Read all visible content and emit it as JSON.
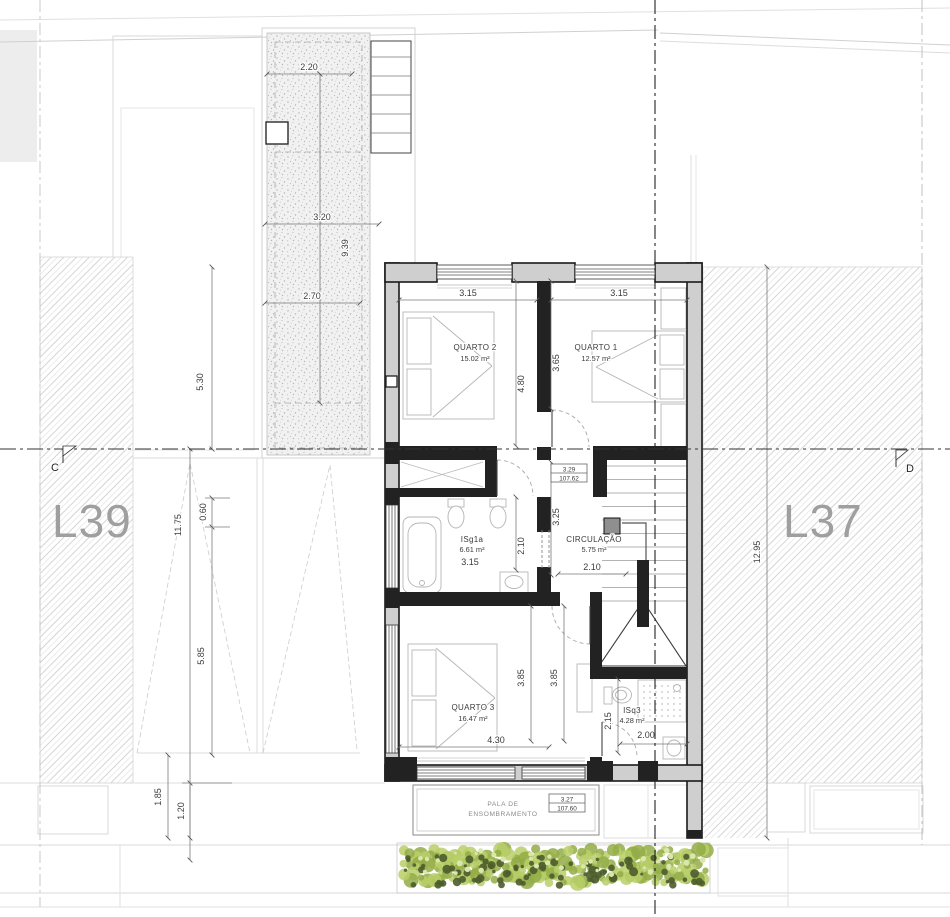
{
  "drawing": {
    "lots": {
      "left_label": "L39",
      "right_label": "L37"
    },
    "section_markers": {
      "left": "C",
      "right": "D"
    },
    "rooms": {
      "quarto2": {
        "name": "QUARTO 2",
        "area": "15.02 m²"
      },
      "quarto1": {
        "name": "QUARTO 1",
        "area": "12.57 m²"
      },
      "isg1a": {
        "name": "ISg1a",
        "area": "6.61 m²",
        "width_label": "3.15"
      },
      "circulacao": {
        "name": "CIRCULAÇÃO",
        "area": "5.75 m²",
        "width_label": "2.10"
      },
      "quarto3": {
        "name": "QUARTO 3",
        "area": "16.47 m²"
      },
      "isq3": {
        "name": "ISq3",
        "area": "4.28 m²"
      }
    },
    "levels": {
      "hall": {
        "height": "3.29",
        "elevation": "107.62"
      },
      "pala": {
        "height": "3.27",
        "elevation": "107.60"
      }
    },
    "pala": {
      "line1": "PALA DE",
      "line2": "ENSOMBRAMENTO"
    },
    "dims": {
      "terrace_top": "2.20",
      "terrace_mid": "3.20",
      "terrace_vert": "9.39",
      "terrace_low": "2.70",
      "site_left_upper": "5.30",
      "site_left_total": "11.75",
      "site_left_small": "0.60",
      "site_left_lower": "5.85",
      "site_left_b1": "1.85",
      "site_left_b2": "1.20",
      "site_right": "12.95",
      "q2_width": "3.15",
      "q1_width": "3.15",
      "q2_depth": "4.80",
      "q1_depth": "3.65",
      "hall_depth": "3.25",
      "isg1a_depth": "2.10",
      "q3_depth_a": "3.85",
      "q3_depth_b": "3.85",
      "q3_width": "4.30",
      "isq3_depth": "2.15",
      "isq3_width": "2.00"
    },
    "colors": {
      "wall_fill": "#cfcfcf",
      "wall_line": "#1a1a1a",
      "hatch_line": "#d4d4d4",
      "dim_line": "#7a7a7a",
      "text": "#3b3b3b",
      "lot_label": "#9f9f9f",
      "hedge": [
        "#b9cf68",
        "#93ab47",
        "#4c5c2c",
        "#dbe6ad"
      ]
    }
  }
}
